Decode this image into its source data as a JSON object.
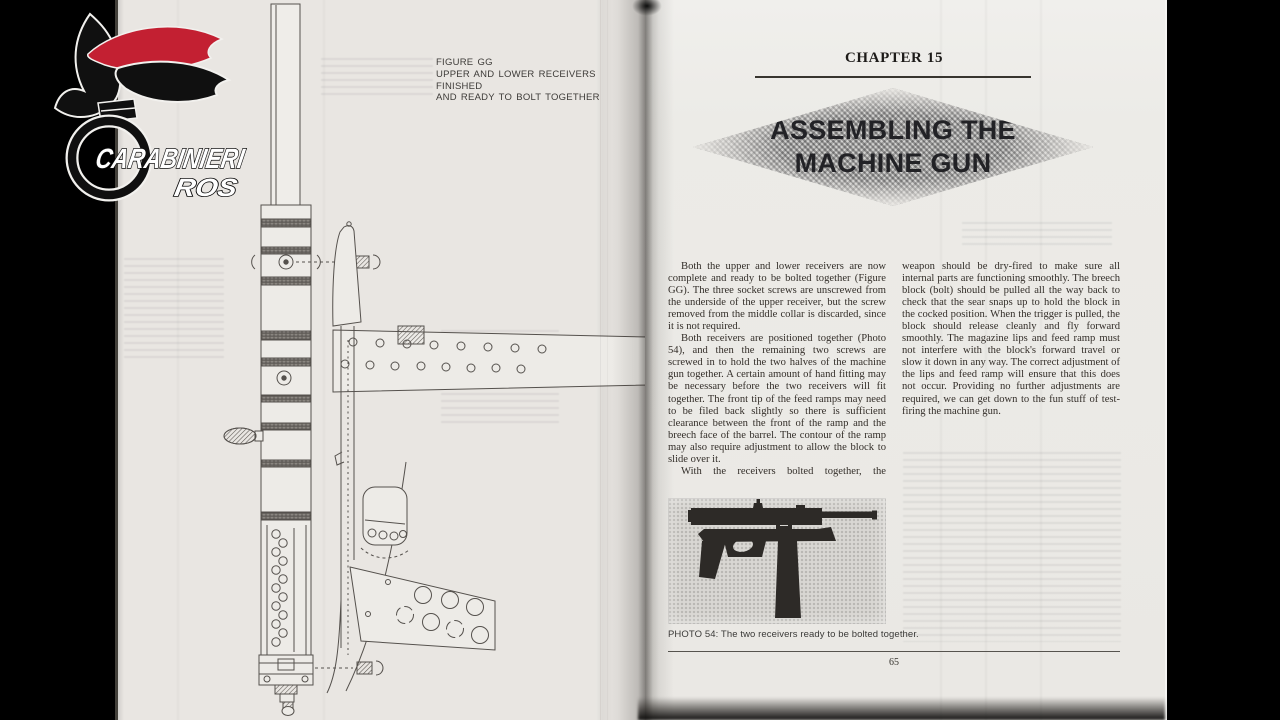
{
  "watermark": {
    "org": "CARABINIERI",
    "unit": "ROS"
  },
  "left_page": {
    "figure_caption": {
      "line1": "FIGURE GG",
      "line2": "UPPER AND LOWER RECEIVERS FINISHED",
      "line3": "AND READY TO BOLT TOGETHER"
    }
  },
  "right_page": {
    "chapter_heading": "CHAPTER 15",
    "title": {
      "line1": "ASSEMBLING THE",
      "line2": "MACHINE GUN"
    },
    "body": {
      "column1": [
        "Both the upper and lower receivers are now complete and ready to be bolted together (Figure GG). The three socket screws are unscrewed from the underside of the upper receiver, but the screw removed from the middle collar is discarded, since it is not required.",
        "Both receivers are positioned together (Photo 54), and then the remaining two screws are screwed in to hold the two halves of the machine gun together. A certain amount of hand fitting may be necessary before the two receivers will fit together. The front tip of the feed ramps may need to be filed back slightly so there is sufficient clearance between the front of the ramp and the breech face of the barrel. The contour of the ramp may also require adjustment to allow the block to slide over it.",
        "With the receivers bolted together, the"
      ],
      "column2": [
        "weapon should be dry-fired to make sure all internal parts are functioning smoothly. The breech block (bolt) should be pulled all the way back to check that the sear snaps up to hold the block in the cocked position. When the trigger is pulled, the block should release cleanly and fly forward smoothly. The magazine lips and feed ramp must not interfere with the block's forward travel or slow it down in any way. The correct adjustment of the lips and feed ramp will ensure that this does not occur. Providing no further adjustments are required, we can get down to the fun stuff of test-firing the machine gun."
      ]
    },
    "photo_caption": "PHOTO 54: The two receivers ready to be bolted together.",
    "page_number": "65"
  },
  "colors": {
    "logo_red": "#c32032",
    "page_background": "#e9e6e2",
    "ink": "#332e29",
    "diamond_gray": "#b7b6b3"
  }
}
